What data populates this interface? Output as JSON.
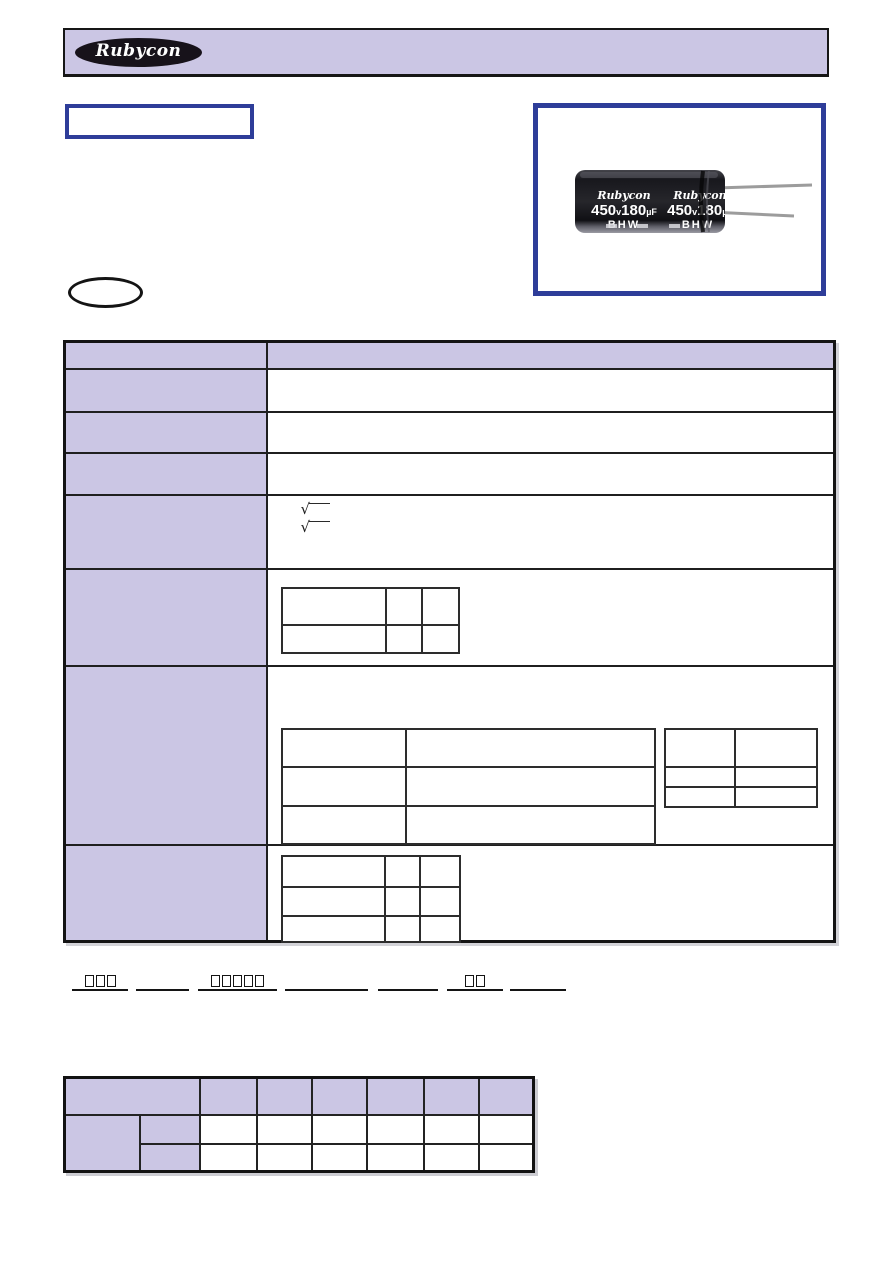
{
  "header_bar": {
    "logo_text": "Rubycon"
  },
  "model_box": {
    "text": ""
  },
  "photo": {
    "capacitor_print": {
      "brand": "Rubycon",
      "voltage": "450",
      "voltage_unit": "v",
      "capacitance": "180",
      "capacitance_unit": "µF",
      "series": "BHW"
    }
  },
  "ellipse_badge": {
    "text": ""
  },
  "spec_table": {
    "radical": "√",
    "header": {
      "item_label": "",
      "spec_label": ""
    },
    "row_labels": [
      "",
      "",
      "",
      "",
      "",
      "",
      ""
    ],
    "tan_delta_table": {
      "cells": [
        [
          "",
          "",
          ""
        ],
        [
          "",
          "",
          ""
        ]
      ]
    },
    "endurance_conditions_table": {
      "cells": [
        [
          "",
          ""
        ],
        [
          "",
          ""
        ],
        [
          "",
          ""
        ]
      ]
    },
    "endurance_limits_table": {
      "cells": [
        [
          "",
          ""
        ],
        [
          "",
          ""
        ],
        [
          "",
          ""
        ]
      ]
    },
    "impedance_ratio_table": {
      "cells": [
        [
          "",
          "",
          ""
        ],
        [
          "",
          "",
          ""
        ],
        [
          "",
          "",
          ""
        ]
      ]
    }
  },
  "part_line": {
    "segments": [
      {
        "placeholder_boxes": 3
      },
      {
        "placeholder_boxes": 0
      },
      {
        "placeholder_boxes": 5
      },
      {
        "placeholder_boxes": 0
      },
      {
        "placeholder_boxes": 0
      },
      {
        "placeholder_boxes": 2
      },
      {
        "placeholder_boxes": 0
      }
    ]
  },
  "frequency_table": {
    "header_cells": [
      "",
      "",
      "",
      "",
      "",
      "",
      ""
    ],
    "row_labels": [
      "",
      "",
      ""
    ],
    "cells": [
      [
        "",
        "",
        "",
        "",
        "",
        ""
      ],
      [
        "",
        "",
        "",
        "",
        "",
        ""
      ]
    ]
  }
}
